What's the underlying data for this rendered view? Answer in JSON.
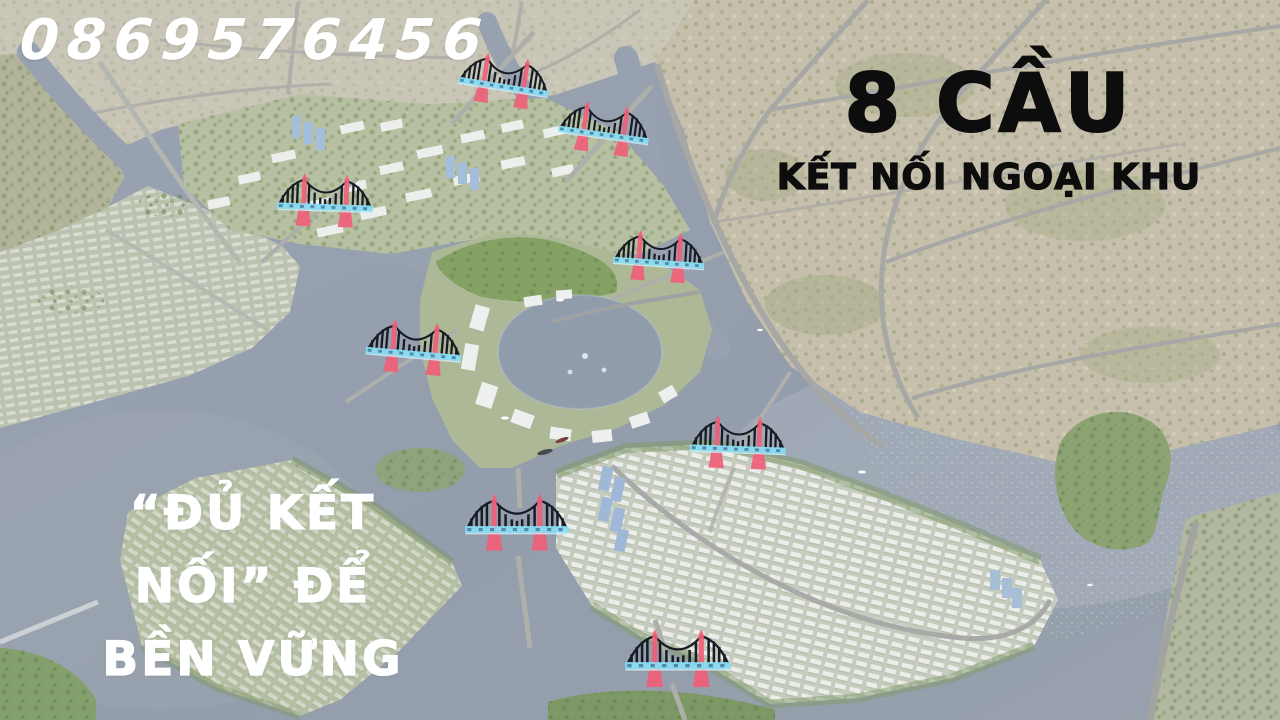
{
  "overlay": {
    "phone_number": "0869576456",
    "headline_title": "8 CẦU",
    "headline_subtitle": "KẾT NỐI NGOẠI KHU",
    "slogan_line1": "“ĐỦ KẾT",
    "slogan_line2": "NỐI” ĐỂ",
    "slogan_line3": "BỀN VỮNG"
  },
  "map": {
    "bridge_count": 8,
    "bridge_markers": [
      {
        "x": 504,
        "y": 90,
        "rotation": 9,
        "scale": 0.95
      },
      {
        "x": 604,
        "y": 138,
        "rotation": 8,
        "scale": 0.95
      },
      {
        "x": 325,
        "y": 210,
        "rotation": 2,
        "scale": 1.0
      },
      {
        "x": 659,
        "y": 266,
        "rotation": 4,
        "scale": 0.95
      },
      {
        "x": 414,
        "y": 357,
        "rotation": 5,
        "scale": 1.0
      },
      {
        "x": 738,
        "y": 452,
        "rotation": 2,
        "scale": 1.0
      },
      {
        "x": 517,
        "y": 532,
        "rotation": 0,
        "scale": 1.08
      },
      {
        "x": 678,
        "y": 668,
        "rotation": 0,
        "scale": 1.1
      }
    ]
  },
  "colors": {
    "overlay_text_white": "#ffffff",
    "headline_text": "#0d0d0d",
    "bridge_tower_pink": "#ef6079",
    "bridge_deck_cyan": "#8adcf2",
    "water": "#95a0af",
    "beige_land": "#c6bfac"
  }
}
